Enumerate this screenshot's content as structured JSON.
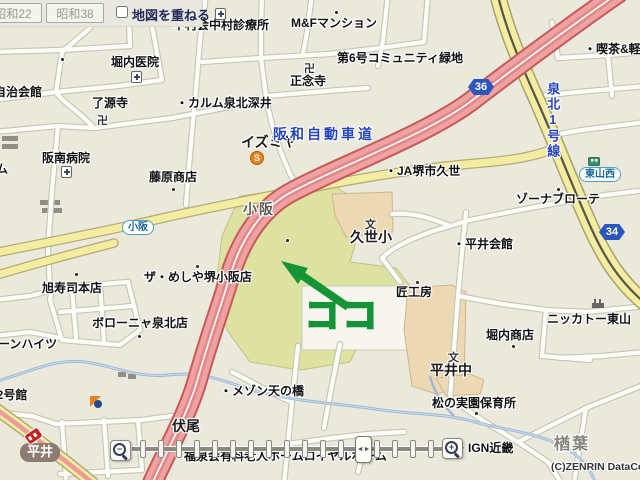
{
  "toolbar": {
    "btn_showa22": "昭和22",
    "btn_showa38": "昭和38",
    "overlay_label": "地図を重ねる"
  },
  "annotation": {
    "park_label": "原池公園",
    "koko": "ココ",
    "green": "#149437"
  },
  "slider": {
    "zoom_out_glyph": "−",
    "zoom_in_glyph": "+",
    "thumb_glyph": "◄►",
    "tick_start": 140,
    "tick_step": 18,
    "tick_count": 17
  },
  "colors": {
    "background": "#ebe9dc",
    "highway": "#f0a2a2",
    "major_road": "#f4eca0",
    "park": "#dde2a0",
    "river": "#9db8d6",
    "annotation_green": "#149437"
  },
  "map_labels": [
    {
      "name": "label-nakamura-clinic",
      "text": "中村会中村診療所",
      "x": 173,
      "y": 19,
      "cls": "poi"
    },
    {
      "name": "label-mf-mansion",
      "text": "M&Fマンション",
      "x": 291,
      "y": 17,
      "cls": "poi"
    },
    {
      "name": "label-horiuchi-iin",
      "text": "堀内医院",
      "x": 111,
      "y": 56,
      "cls": "poi"
    },
    {
      "name": "label-jichikaikan",
      "text": "自治会館",
      "x": -6,
      "y": 86,
      "cls": "poi"
    },
    {
      "name": "label-ryogenji",
      "text": "了源寺",
      "x": 92,
      "y": 97,
      "cls": "poi"
    },
    {
      "name": "label-calm-senboku-fukai",
      "text": "・カルム泉北深井",
      "x": 176,
      "y": 97,
      "cls": "poi"
    },
    {
      "name": "label-shonenji",
      "text": "正念寺",
      "x": 290,
      "y": 75,
      "cls": "poi"
    },
    {
      "name": "label-community-ryokuchi",
      "text": "第6号コミュニティ緑地",
      "x": 337,
      "y": 52,
      "cls": "poi"
    },
    {
      "name": "label-kissa",
      "text": "・喫茶&軽",
      "x": 584,
      "y": 43,
      "cls": "poi"
    },
    {
      "name": "label-izumiya",
      "text": "イズミヤ",
      "x": 241,
      "y": 135,
      "cls": "poi-lg"
    },
    {
      "name": "label-ja-sakai-kuze",
      "text": "・JA堺市久世",
      "x": 385,
      "y": 165,
      "cls": "poi"
    },
    {
      "name": "label-zona-brote",
      "text": "ゾーナブローテ",
      "x": 516,
      "y": 193,
      "cls": "poi"
    },
    {
      "name": "label-fujiwara-shoten",
      "text": "藤原商店",
      "x": 149,
      "y": 171,
      "cls": "poi"
    },
    {
      "name": "label-hannan-byoin",
      "text": "阪南病院",
      "x": 42,
      "y": 152,
      "cls": "poi"
    },
    {
      "name": "label-clipped-mu",
      "text": "ム",
      "x": -4,
      "y": 163,
      "cls": "poi"
    },
    {
      "name": "label-asahizushi",
      "text": "旭寿司本店",
      "x": 42,
      "y": 282,
      "cls": "poi"
    },
    {
      "name": "label-za-meshiya",
      "text": "ザ・めしや堺小阪店",
      "x": 144,
      "y": 271,
      "cls": "poi"
    },
    {
      "name": "label-bologna-senboku",
      "text": "ボローニャ泉北店",
      "x": 92,
      "y": 317,
      "cls": "poi"
    },
    {
      "name": "label-loan-heights",
      "text": "ローンハイツ",
      "x": -14,
      "y": 338,
      "cls": "poi"
    },
    {
      "name": "label-12goukan",
      "text": "12号館",
      "x": -10,
      "y": 389,
      "cls": "poi"
    },
    {
      "name": "label-maison-tennohashi",
      "text": "・メゾン天の橋",
      "x": 220,
      "y": 385,
      "cls": "poi"
    },
    {
      "name": "label-hirai-kaikan",
      "text": "・平井会館",
      "x": 453,
      "y": 238,
      "cls": "poi"
    },
    {
      "name": "label-takumi-kobo",
      "text": "匠工房",
      "x": 396,
      "y": 286,
      "cls": "poi"
    },
    {
      "name": "label-nikkato-higashiyama",
      "text": "ニッカトー東山",
      "x": 547,
      "y": 313,
      "cls": "poi"
    },
    {
      "name": "label-horiuchi-shoten",
      "text": "堀内商店",
      "x": 486,
      "y": 329,
      "cls": "poi"
    },
    {
      "name": "label-matsunomi-hoikusho",
      "text": "松の実園保育所",
      "x": 432,
      "y": 397,
      "cls": "poi"
    },
    {
      "name": "label-ign-kinki",
      "text": "・IGN近畿",
      "x": 456,
      "y": 442,
      "cls": "poi"
    },
    {
      "name": "label-rojin-home",
      "text": "・福泉会有料老人ホームロイヤルホーム",
      "x": 172,
      "y": 450,
      "cls": "poi"
    },
    {
      "name": "label-kosaka-area",
      "text": "小阪",
      "x": 243,
      "y": 202,
      "cls": "area"
    },
    {
      "name": "label-fushio-area",
      "text": "伏尾",
      "x": 172,
      "y": 419,
      "cls": "poi-lg"
    },
    {
      "name": "label-naraha-area",
      "text": "楢葉",
      "x": 554,
      "y": 436,
      "cls": "area-xl"
    },
    {
      "name": "label-hirai-chu",
      "text": "平井中",
      "x": 430,
      "y": 363,
      "cls": "poi-lg"
    },
    {
      "name": "label-kuze-sho",
      "text": "久世小",
      "x": 350,
      "y": 230,
      "cls": "poi-lg"
    },
    {
      "name": "label-hanwa-expressway",
      "text": "阪和自動車道",
      "x": 273,
      "y": 127,
      "cls": "road-blue"
    },
    {
      "name": "label-senboku-1go-sen",
      "text": "泉北1号線",
      "x": 545,
      "y": 82,
      "cls": "road-blue-v"
    },
    {
      "name": "label-copyright",
      "text": "(C)ZENRIN DataCom",
      "x": 551,
      "y": 462,
      "cls": "copyright"
    }
  ],
  "map_dots": [
    [
      335,
      11
    ],
    [
      61,
      58
    ],
    [
      172,
      188
    ],
    [
      75,
      273
    ],
    [
      196,
      265
    ],
    [
      138,
      335
    ],
    [
      416,
      281
    ],
    [
      512,
      345
    ],
    [
      475,
      412
    ],
    [
      557,
      188
    ],
    [
      286,
      239
    ]
  ],
  "map_icons": [
    {
      "name": "hospital-icon",
      "type": "hospital",
      "x": 215,
      "y": 8
    },
    {
      "name": "hospital-icon",
      "type": "hospital",
      "x": 131,
      "y": 71
    },
    {
      "name": "hospital-icon",
      "type": "hospital",
      "x": 61,
      "y": 166
    },
    {
      "name": "temple-icon",
      "type": "temple",
      "x": 97,
      "y": 112,
      "text": "卍"
    },
    {
      "name": "temple-icon",
      "type": "temple",
      "x": 304,
      "y": 60,
      "text": "卍"
    },
    {
      "name": "school-icon",
      "type": "school",
      "x": 365,
      "y": 216,
      "text": "文"
    },
    {
      "name": "school-icon",
      "type": "school",
      "x": 448,
      "y": 349,
      "text": "文"
    },
    {
      "name": "factory-icon",
      "type": "factory",
      "x": 592,
      "y": 299
    },
    {
      "name": "supermarket-icon",
      "type": "smark",
      "x": 250,
      "y": 151,
      "text": "S"
    },
    {
      "name": "route-badge-36",
      "type": "badge",
      "x": 468,
      "y": 79,
      "text": "36"
    },
    {
      "name": "route-badge-34",
      "type": "badge",
      "x": 599,
      "y": 224,
      "text": "34"
    },
    {
      "name": "station-pill-hirai",
      "type": "pill",
      "x": 20,
      "y": 443,
      "text": "平井"
    },
    {
      "name": "busstop-kosaka",
      "type": "busstop withbus",
      "x": 122,
      "y": 220,
      "text": "小阪"
    },
    {
      "name": "busstop-higashiyamanishi",
      "type": "busstop",
      "x": 579,
      "y": 167,
      "text": "東山西"
    },
    {
      "name": "bus-icon",
      "type": "bus",
      "x": 588,
      "y": 157
    },
    {
      "name": "road-sign-icon",
      "type": "redbadge",
      "x": 25,
      "y": 430
    },
    {
      "name": "store-icon",
      "type": "store",
      "x": 90,
      "y": 396
    }
  ]
}
